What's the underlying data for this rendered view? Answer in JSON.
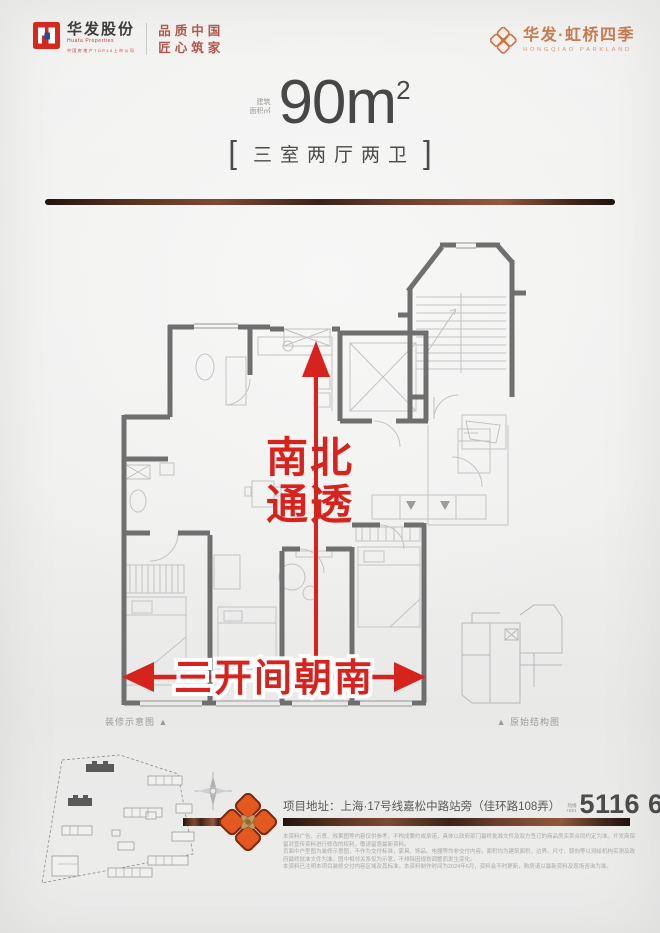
{
  "header": {
    "brand_left": {
      "name": "华发股份",
      "name_en": "Huafa Properties",
      "sub": "中国房地产TOP10上市公司",
      "slogan1": "品质中国",
      "slogan2": "匠心筑家"
    },
    "brand_right": {
      "name": "华发·虹桥四季",
      "name_en": "HONGQIAO PARKLAND"
    }
  },
  "hero": {
    "area_label1": "建筑",
    "area_label2": "面积㎡",
    "area_value": "90m",
    "area_exp": "2",
    "bracket_left": "[",
    "bracket_right": "]",
    "layout": "三室两厅两卫"
  },
  "floorplan": {
    "tag_vertical1": "南北",
    "tag_vertical2": "通透",
    "tag_horizontal": "三开间朝南",
    "caption_left": "装修示意图 ▲",
    "caption_right": "▲ 原始结构图"
  },
  "footer": {
    "address_label": "项目地址：",
    "address": "上海·17号线嘉松中路站旁（佳环路108弄）",
    "hotline_label": "热线",
    "hotline_area": "+021",
    "phone": "5116 6677",
    "disclaimer": [
      "本资料广告、示意、效果图等内容仅供参考，不构成要约或承诺，具体以政府部门最终批准文件及双方签订的商品房买卖合同约定为准。开发商保留对宣传资料进行修改的权利，敬请留意最新资料。",
      "页面中户型图为装修示意图，不作为交付标准，家具、饰品、电器等均非交付内容。面积均为建筑面积，边界、尺寸、朝向等以测绘机构实测及政府最终批准文件为准。图中相邻关系仅为示意，不排除因规划调整而发生变化。",
      "本资料已注明本项目装修交付内容区域及其标准，本资料制作时间为2024年6月，资料会不时更新，购房请以最新资料及现场咨询为准。"
    ]
  },
  "colors": {
    "accent_red": "#d7231d",
    "brand_red": "#d5281e",
    "orange": "#cd7040",
    "copper": "#6e4130",
    "wall_gray": "#6f6f6f",
    "text_dark": "#474747"
  }
}
